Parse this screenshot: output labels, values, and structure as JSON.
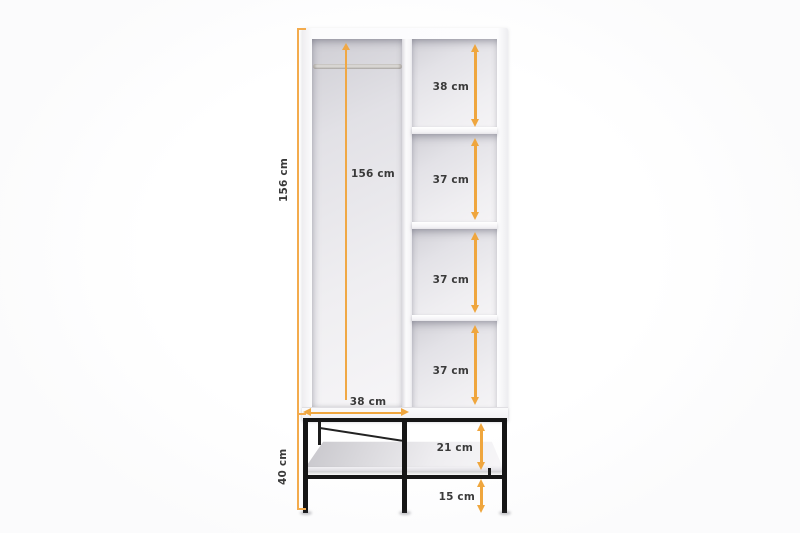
{
  "unit": "cm",
  "colors": {
    "accent_arrow": "#EFA63E",
    "dimension_line": "#F3AB4D",
    "label_text": "#3A3A3A",
    "metal_frame": "#161616",
    "cabinet_white": "#FAFAFB"
  },
  "dims": {
    "total_height": "156 cm",
    "interior_height": "156 cm",
    "compartment_1_height": "38 cm",
    "compartment_2_height": "37 cm",
    "compartment_3_height": "37 cm",
    "compartment_4_height": "37 cm",
    "left_compartment_width": "38 cm",
    "base_shelf_clearance": "21 cm",
    "base_floor_clearance": "15 cm",
    "base_height": "40 cm"
  }
}
